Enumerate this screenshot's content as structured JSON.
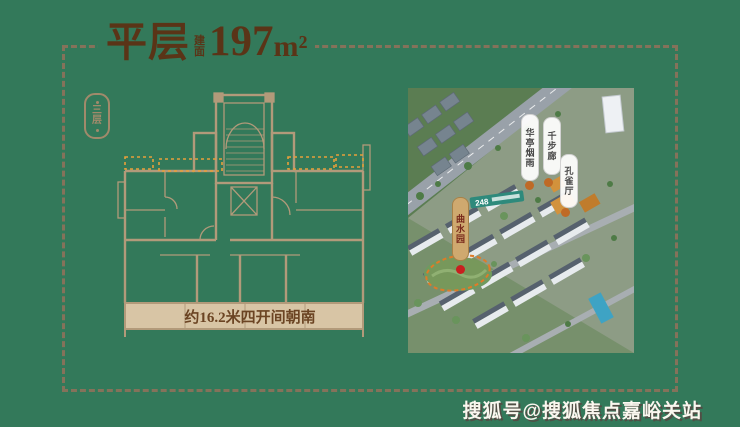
{
  "page": {
    "background_color": "#33795a",
    "frame_dash_color": "#85725a"
  },
  "title": {
    "main": "平层",
    "sub_vertical": "建面",
    "area": "197",
    "unit": "m²",
    "color": "#5a3417"
  },
  "side_badge": {
    "label": "三层"
  },
  "floor_plan": {
    "dimension_note": "约16.2米四开间朝南",
    "line_color": "#b29a7a",
    "highlight_color": "#e8a03a",
    "band_fill": "#d8c5a5",
    "note_color": "#6b4423"
  },
  "aerial_map": {
    "markers": [
      {
        "label": "曲水园",
        "style": "gold"
      },
      {
        "label": "华亭烟雨",
        "style": "white"
      },
      {
        "label": "千步廊",
        "style": "white"
      },
      {
        "label": "孔雀厅",
        "style": "white"
      }
    ],
    "banner": "248",
    "highlight_ellipse_color": "#e07b28"
  },
  "watermark": {
    "text": "搜狐号@搜狐焦点嘉峪关站"
  }
}
